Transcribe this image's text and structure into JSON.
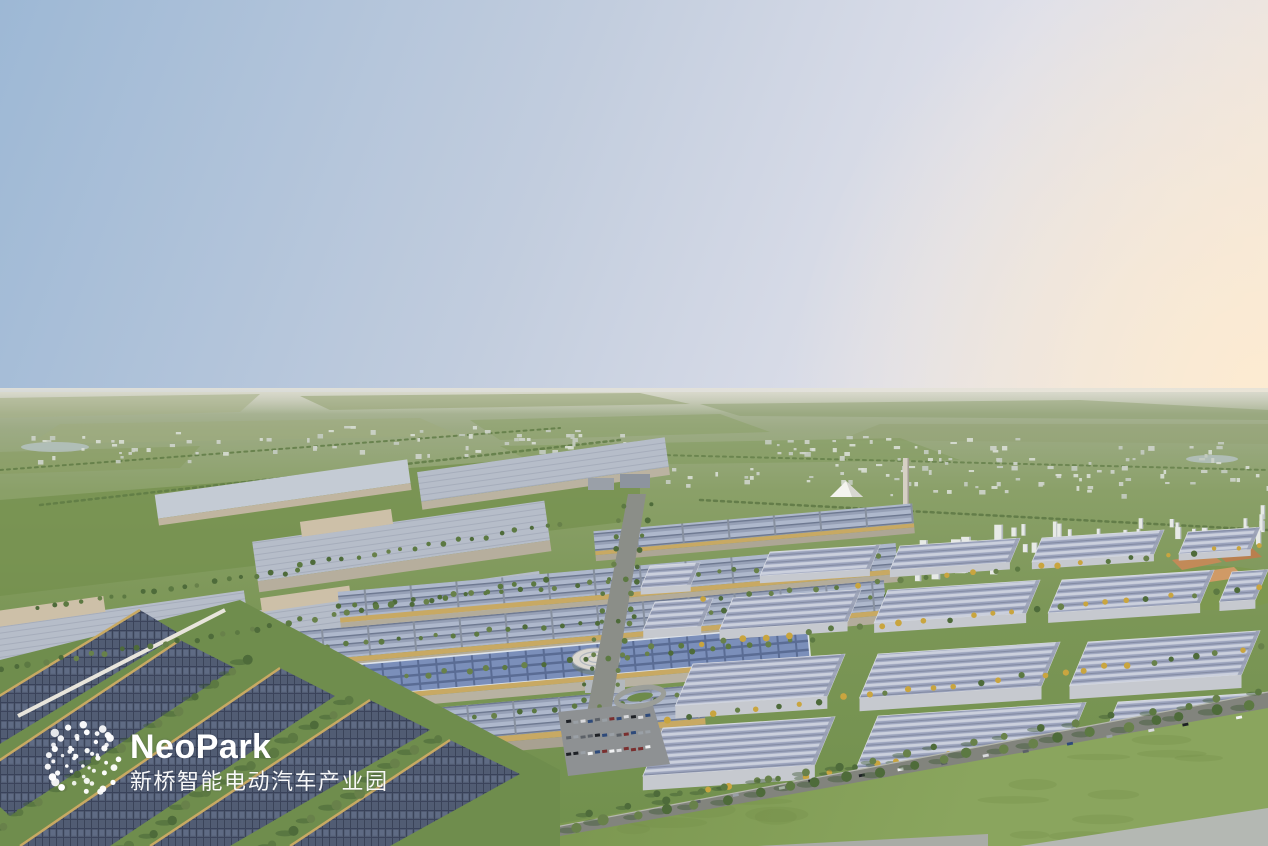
{
  "brand": {
    "name": "NeoPark",
    "subtitle": "新桥智能电动汽车产业园",
    "logo_mark": "dot-cluster"
  },
  "palette": {
    "sky_blue": "#9db8d5",
    "sky_lavender": "#dcdfe9",
    "sky_peach": "#f6e9dc",
    "horizon_haze": "#c6cabb",
    "field_olive": "#8ba06a",
    "lawn_green": "#7f9b53",
    "solar_navy": "#46506a",
    "roof_slate": "#97a0b4",
    "roof_lavender": "#b6bdc9",
    "warehouse_roof": "#9ba3bc",
    "factory_beige": "#cdc0a8",
    "gold_trim": "#c8a963",
    "road_gray": "#82847d",
    "water_gray": "#b3b7b2",
    "tower_white": "#e7eae6",
    "tower_shade": "#b2b8bc",
    "tree_greens": [
      "#4e6b3a",
      "#5c7942",
      "#68814a"
    ],
    "tree_yellow": "#c9a53f",
    "tree_shadow": "#3c5833",
    "town_whites": [
      "#d8ddd4",
      "#cdd3ca",
      "#c3cbc0"
    ],
    "car_colors": [
      "#1e2126",
      "#f2f3f4",
      "#9aa0a6",
      "#2e4a7a",
      "#5c6168",
      "#7a2f2f",
      "#d9dadd"
    ],
    "logo_white": "#ffffff"
  }
}
